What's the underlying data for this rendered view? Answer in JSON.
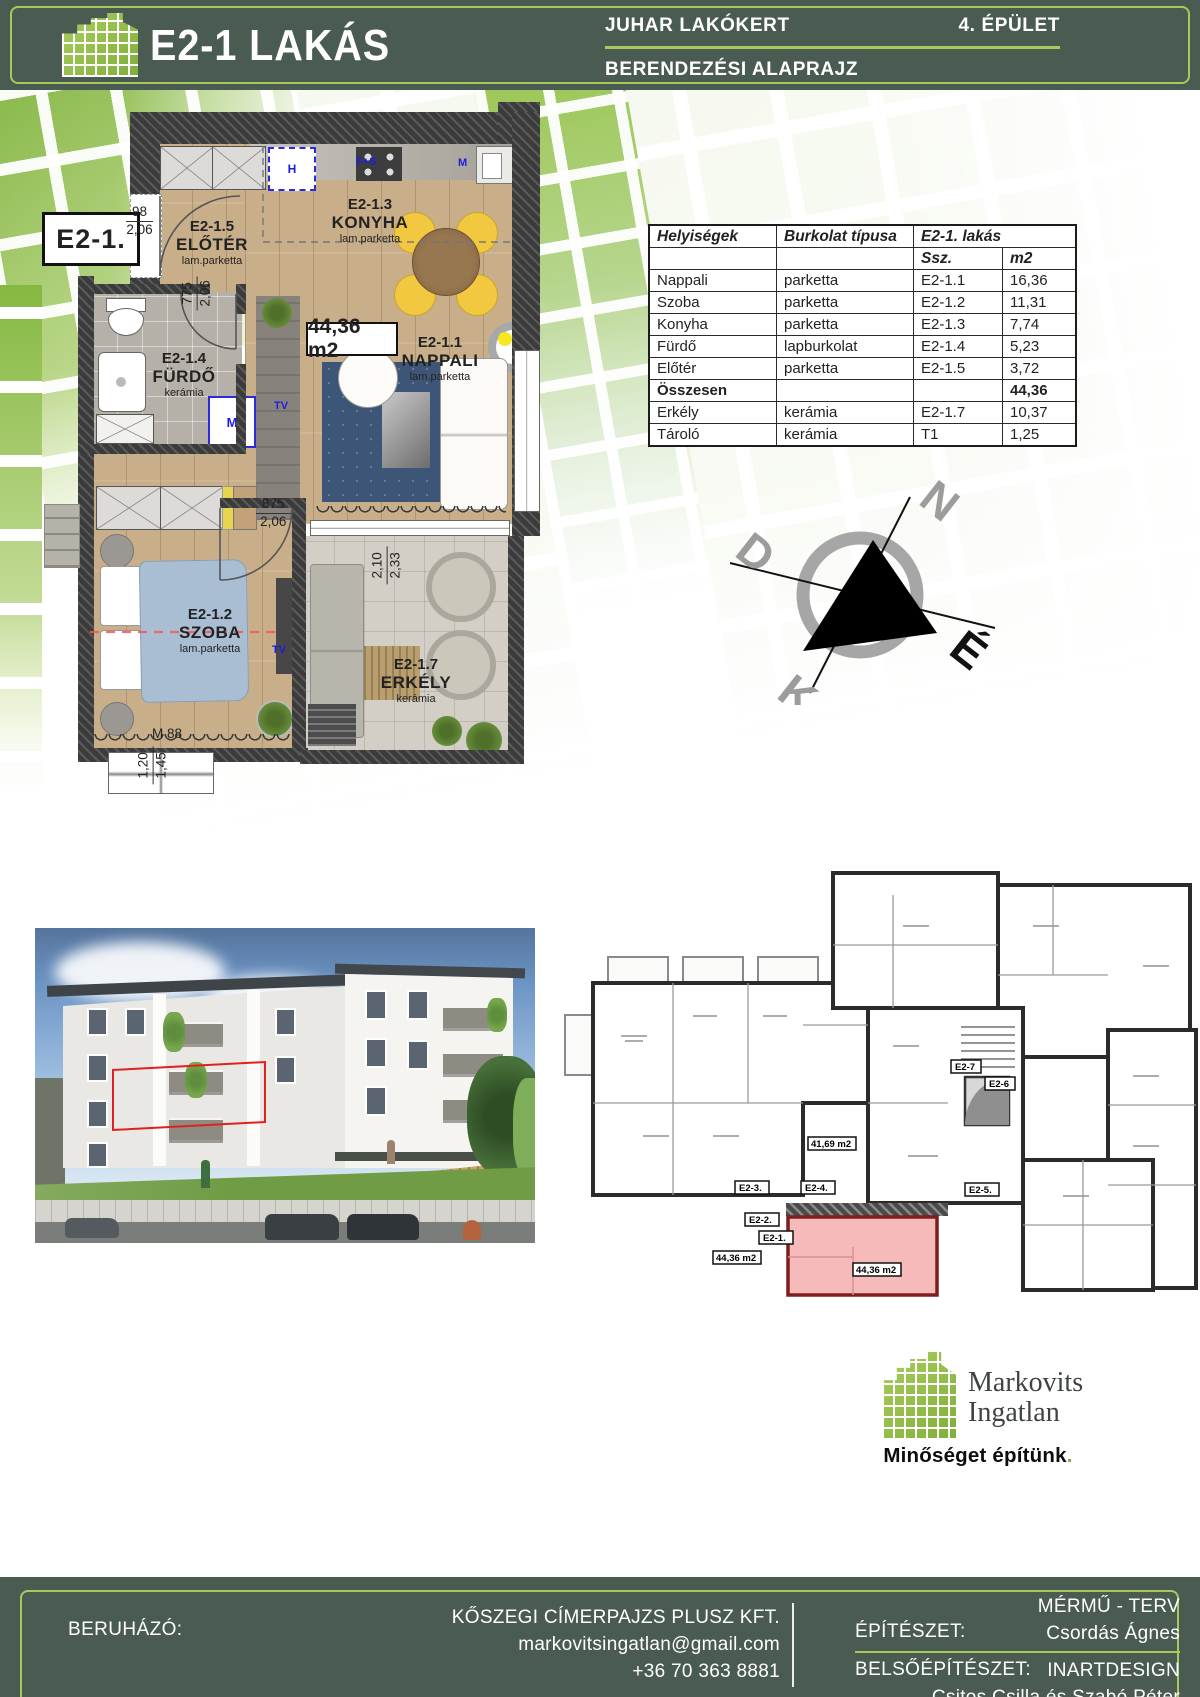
{
  "header": {
    "title": "E2-1 LAKÁS",
    "project": "JUHAR LAKÓKERT",
    "building": "4. ÉPÜLET",
    "subtitle": "BERENDEZÉSI ALAPRAJZ"
  },
  "plan": {
    "unit_badge": "E2-1.",
    "total_area": "44,36 m2",
    "rooms": {
      "nappali": {
        "code": "E2-1.1",
        "name": "NAPPALI",
        "finish": "lam.parketta"
      },
      "szoba": {
        "code": "E2-1.2",
        "name": "SZOBA",
        "finish": "lam.parketta"
      },
      "konyha": {
        "code": "E2-1.3",
        "name": "KONYHA",
        "finish": "lam.parketta"
      },
      "furdo": {
        "code": "E2-1.4",
        "name": "FÜRDŐ",
        "finish": "kerámia"
      },
      "eloter": {
        "code": "E2-1.5",
        "name": "ELŐTÉR",
        "finish": "lam.parketta"
      },
      "erkely": {
        "code": "E2-1.7",
        "name": "ERKÉLY",
        "finish": "kerámia"
      }
    },
    "dims": {
      "entry": {
        "a": "98",
        "b": "2,06"
      },
      "bath": {
        "a": "775",
        "b": "2,06"
      },
      "bedroom": {
        "a": "875",
        "b": "2,06"
      },
      "balcony": {
        "a": "2,10",
        "b": "2,33"
      },
      "window": {
        "a": "1,20",
        "b": "1,45"
      },
      "window_mark": "M 88"
    },
    "appliances": {
      "hood": "H",
      "stove": "F+S",
      "sink": "M",
      "washer": "M",
      "tv1": "TV",
      "tv2": "TV"
    }
  },
  "table": {
    "headers": {
      "col1": "Helyiségek",
      "col2": "Burkolat típusa",
      "col3": "E2-1. lakás",
      "sub1": "Ssz.",
      "sub2": "m2"
    },
    "rows": [
      {
        "room": "Nappali",
        "finish": "parketta",
        "code": "E2-1.1",
        "area": "16,36"
      },
      {
        "room": "Szoba",
        "finish": "parketta",
        "code": "E2-1.2",
        "area": "11,31"
      },
      {
        "room": "Konyha",
        "finish": "parketta",
        "code": "E2-1.3",
        "area": "7,74"
      },
      {
        "room": "Fürdő",
        "finish": "lapburkolat",
        "code": "E2-1.4",
        "area": "5,23"
      },
      {
        "room": "Előtér",
        "finish": "parketta",
        "code": "E2-1.5",
        "area": "3,72"
      },
      {
        "room": "Összesen",
        "finish": "",
        "code": "",
        "area": "44,36"
      },
      {
        "room": "Erkély",
        "finish": "kerámia",
        "code": "E2-1.7",
        "area": "10,37"
      },
      {
        "room": "Tároló",
        "finish": "kerámia",
        "code": "T1",
        "area": "1,25"
      }
    ]
  },
  "compass": {
    "n": "N",
    "d": "D",
    "k": "K",
    "e": "É"
  },
  "overview": {
    "badges": [
      "E2-1.",
      "E2-2.",
      "E2-3.",
      "E2-4.",
      "E2-5.",
      "E2-6",
      "E2-7"
    ],
    "unit_area": "44,36 m2",
    "area_left": "44,36 m2",
    "area_mid": "41,69 m2"
  },
  "logo": {
    "name1": "Markovits",
    "name2": "Ingatlan",
    "slogan": "Minőséget építünk",
    "dot": "."
  },
  "footer": {
    "investor_label": "BERUHÁZÓ:",
    "investor": "KŐSZEGI CÍMERPAJZS PLUSZ KFT.",
    "email": "markovitsingatlan@gmail.com",
    "phone": "+36 70 363 8881",
    "architecture_label": "ÉPÍTÉSZET:",
    "architecture_company": "MÉRMŰ - TERV",
    "architect": "Csordás Ágnes",
    "interior_label": "BELSŐÉPÍTÉSZET:",
    "interior_company": "INARTDESIGN",
    "interior_designers": "Csitos Csilla és Szabó Péter"
  },
  "colors": {
    "bar_green": "#4a5b52",
    "accent_green": "#a9c95f",
    "logo_green": "#7fae3a",
    "highlight_red": "#e02020",
    "unit_pink": "#f6baba"
  }
}
